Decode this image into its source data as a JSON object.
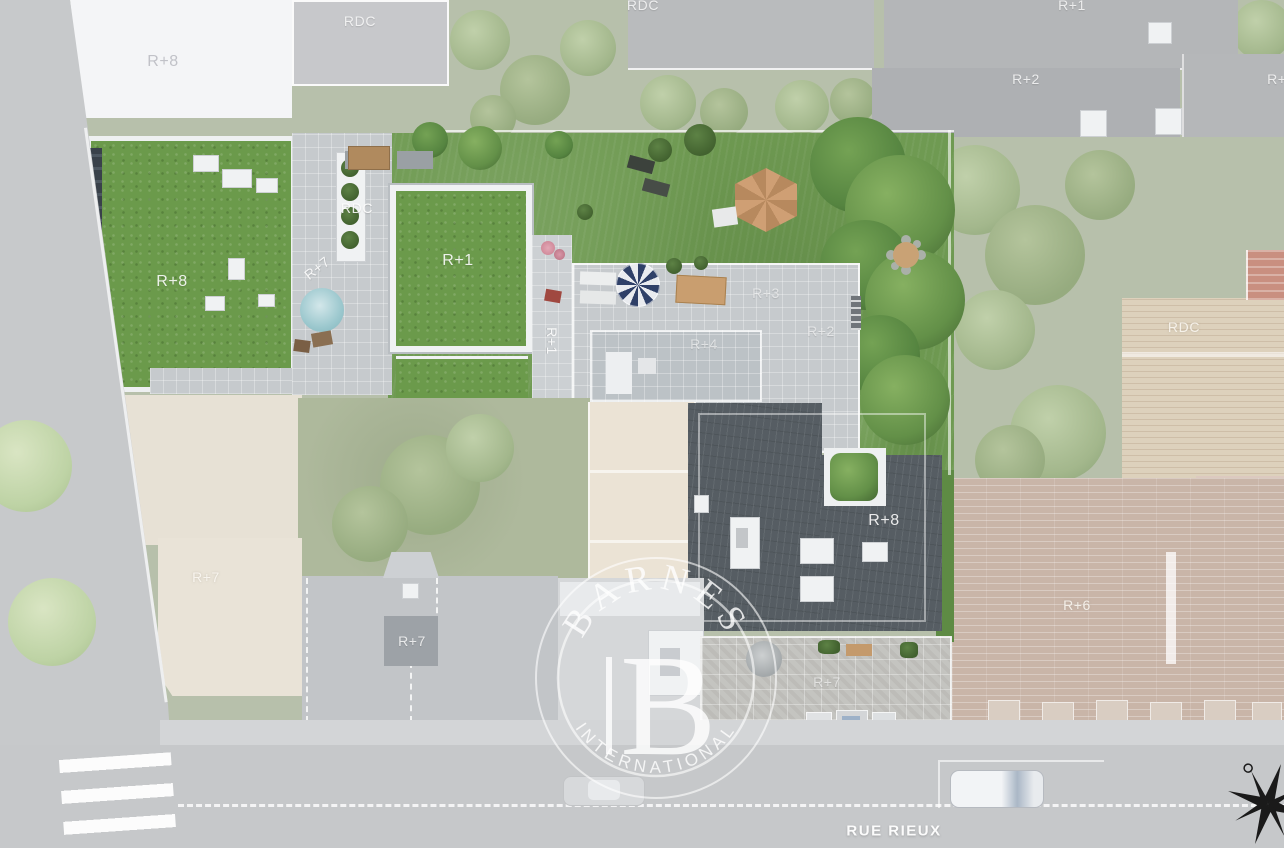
{
  "scene": {
    "type": "aerial-residence-site-plan",
    "street_name": "RUE RIEUX",
    "watermark": {
      "brand": "BARNES",
      "monogram": "B",
      "subtitle": "INTERNATIONAL"
    },
    "compass": "compass-rose"
  },
  "building_labels": [
    {
      "area": "neighbor-top-left-roof",
      "text": "R+8"
    },
    {
      "area": "neighbor-top-rdc",
      "text": "RDC"
    },
    {
      "area": "neighbor-top-center-rdc",
      "text": "RDC"
    },
    {
      "area": "neighbor-top-right-r1",
      "text": "R+1"
    },
    {
      "area": "neighbor-top-right-r2",
      "text": "R+2"
    },
    {
      "area": "neighbor-far-right-r2",
      "text": "R+2"
    },
    {
      "area": "project-green-roof-r8",
      "text": "R+8"
    },
    {
      "area": "project-terrace-rdc",
      "text": "RDC"
    },
    {
      "area": "project-terrace-r7",
      "text": "R+7"
    },
    {
      "area": "project-green-roof-r1",
      "text": "R+1"
    },
    {
      "area": "project-strip-r1",
      "text": "R+1"
    },
    {
      "area": "project-roof-r3",
      "text": "R+3"
    },
    {
      "area": "project-roof-r4",
      "text": "R+4"
    },
    {
      "area": "project-roof-r2",
      "text": "R+2"
    },
    {
      "area": "neighbor-right-deck-rdc",
      "text": "RDC"
    },
    {
      "area": "project-dark-roof-r8",
      "text": "R+8"
    },
    {
      "area": "neighbor-left-r7",
      "text": "R+7"
    },
    {
      "area": "project-building-r7",
      "text": "R+7"
    },
    {
      "area": "neighbor-right-r6",
      "text": "R+6"
    },
    {
      "area": "project-terrace-lower-r7",
      "text": "R+7"
    }
  ],
  "colors": {
    "vivid_lawn": "#6f9a52",
    "green_roof": "#6b9a4b",
    "slate_roof": "#565d63",
    "pavers": "#c6cacd",
    "road": "#c6c8ca",
    "wood_deck": "#ddd1bc",
    "brick_faded": "#c9b5a8",
    "cream_faded": "#eae4d8",
    "watermark_white": "#ffffff",
    "compass_black": "#1a1a1a"
  }
}
